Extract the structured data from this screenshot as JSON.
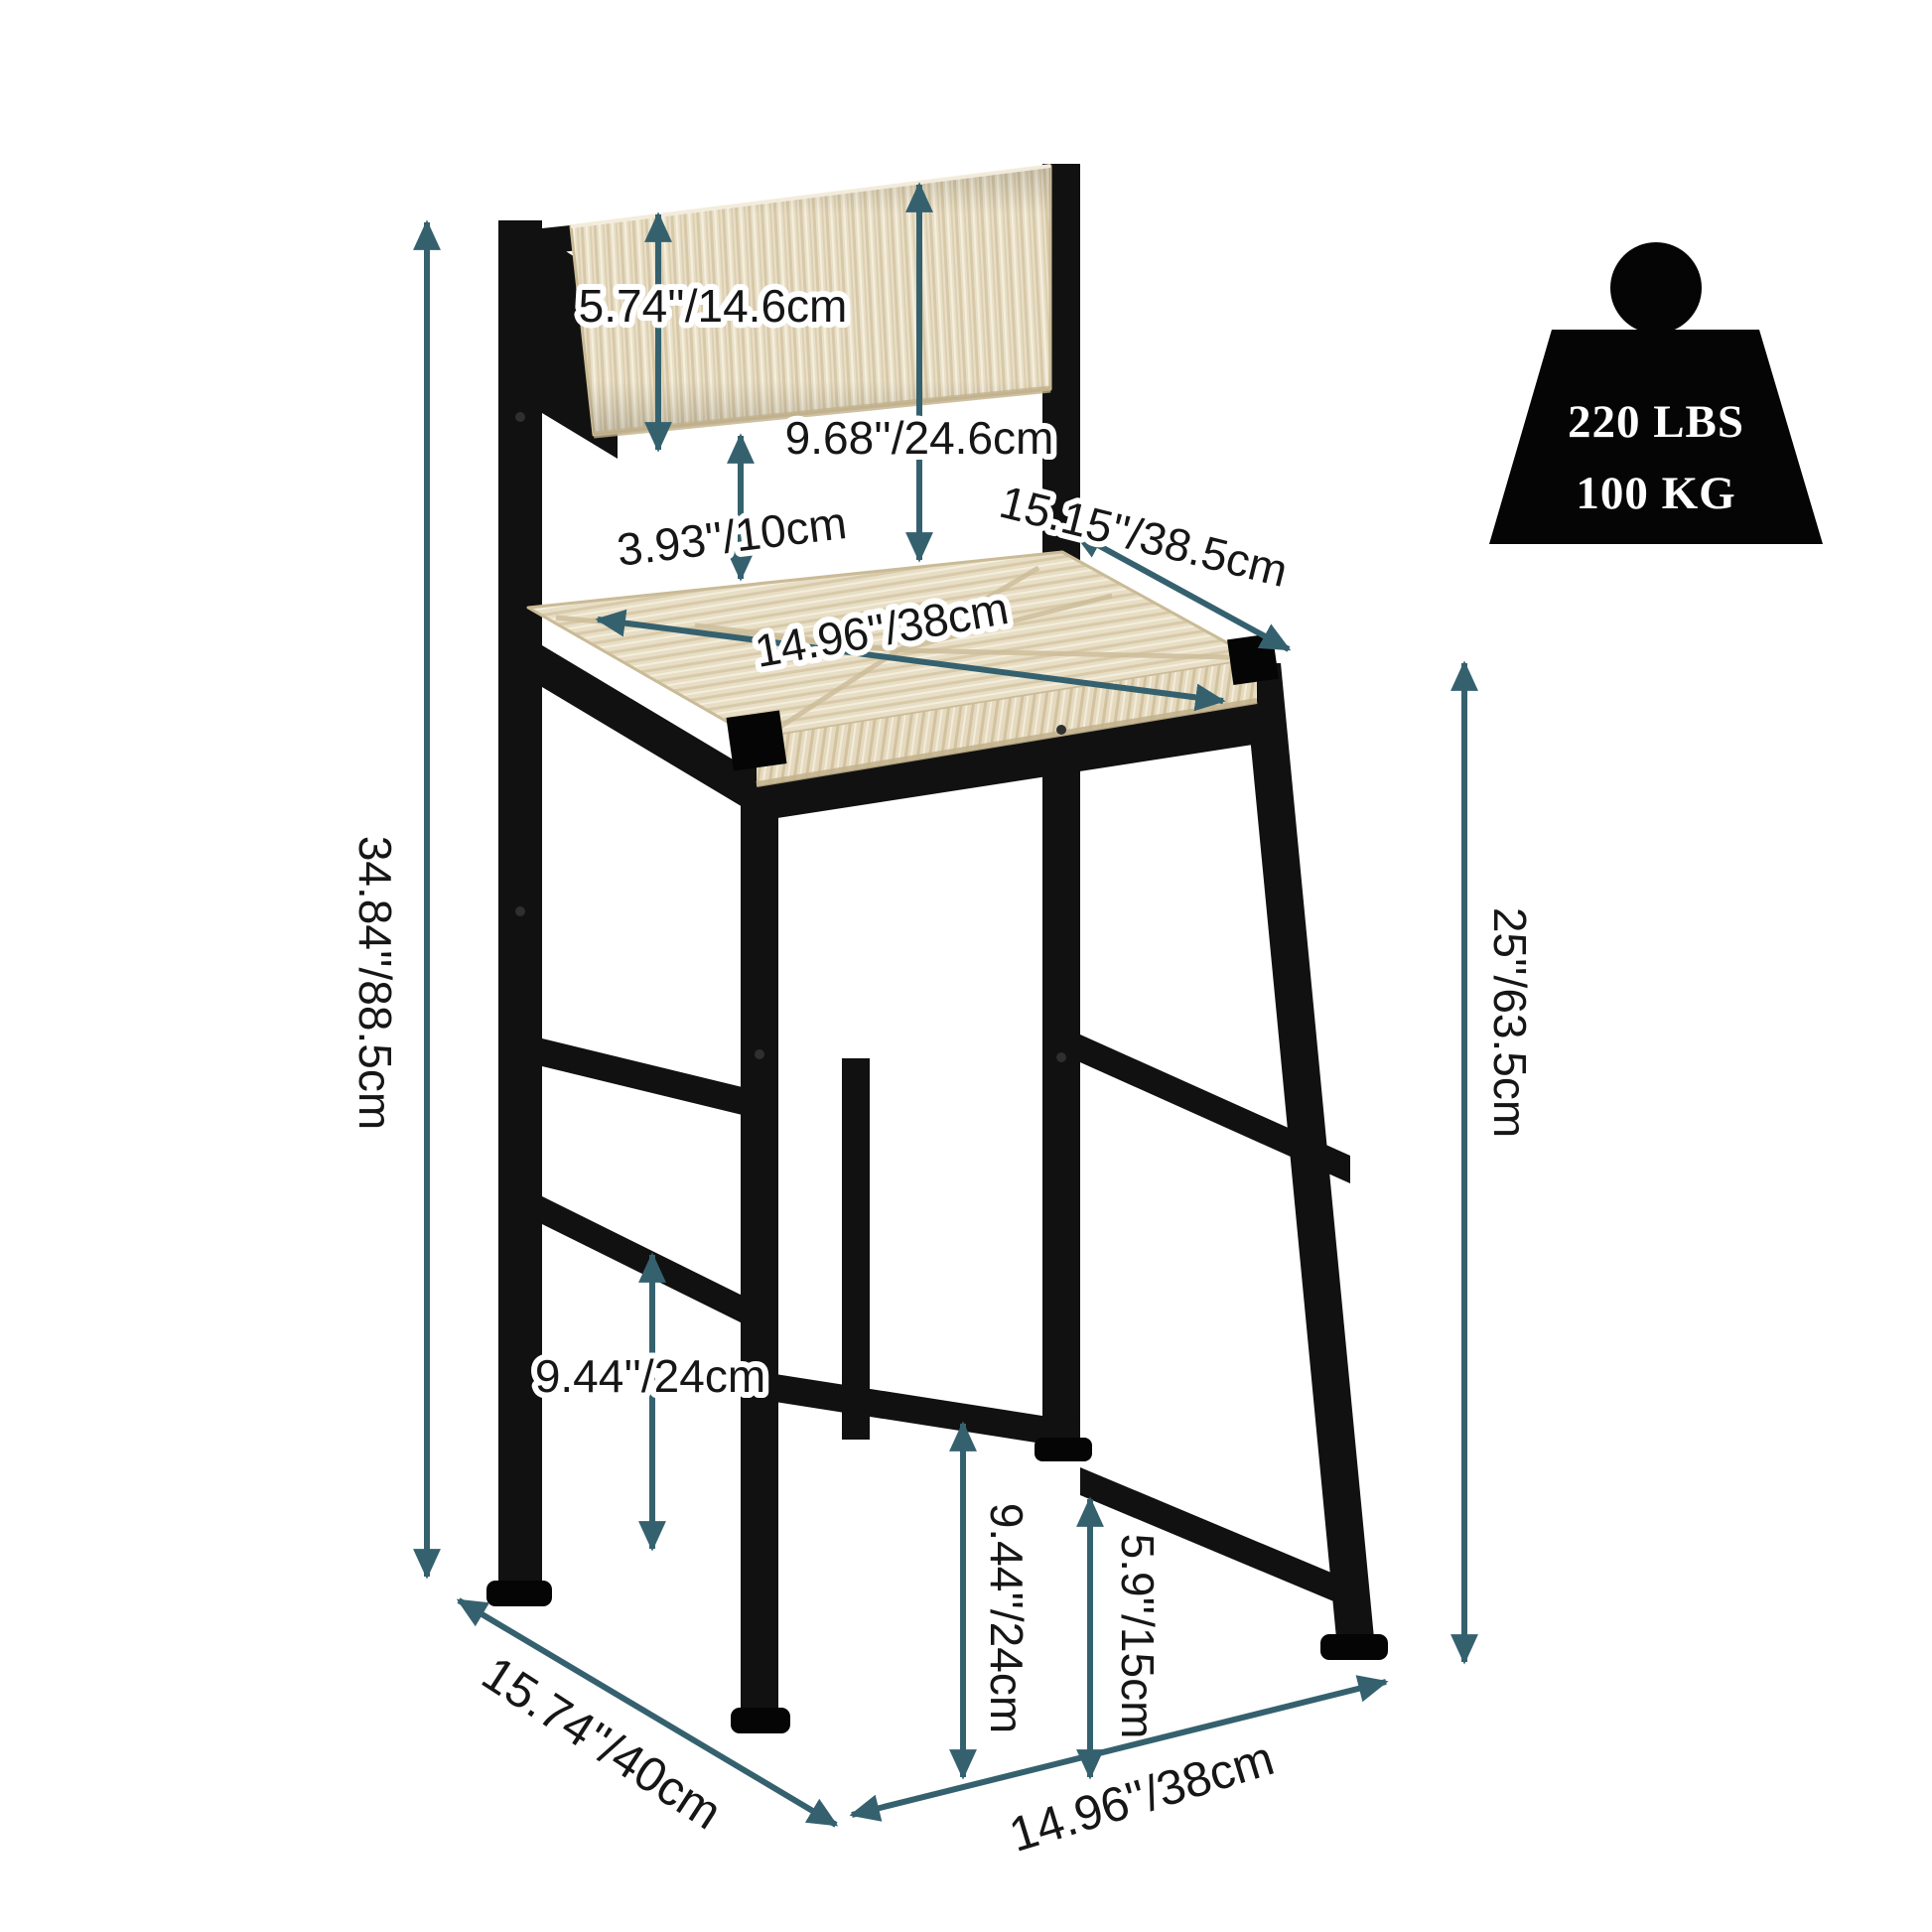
{
  "page": {
    "type": "product-dimension-diagram",
    "product": "Counter-height bar stool with black metal frame and woven paper-rush seat and backrest",
    "background": "#ffffff"
  },
  "colors": {
    "dimension_arrow": "#35616f",
    "label_text": "#161616",
    "frame_black": "#111111",
    "weave_base": "#e9dfc8",
    "weave_shadow": "#d7c9a8",
    "weave_highlight": "#f5efdd",
    "weight_icon": "#050505",
    "weight_text": "#ffffff"
  },
  "weight_capacity": {
    "pounds": "220 LBS",
    "kilograms": "100 KG"
  },
  "dimensions": {
    "total_height": {
      "label": "34.84''/88.5cm"
    },
    "backrest_height": {
      "label": "5.74''/14.6cm"
    },
    "back_top_to_seat": {
      "label": "9.68''/24.6cm"
    },
    "back_to_seat_gap": {
      "label": "3.93''/10cm"
    },
    "seat_depth": {
      "label": "15.15''/38.5cm"
    },
    "seat_width": {
      "label": "14.96''/38cm"
    },
    "seat_height": {
      "label": "25''/63.5cm"
    },
    "footrest_left": {
      "label": "9.44''/24cm"
    },
    "footrest_right": {
      "label": "9.44''/24cm"
    },
    "lower_stretcher": {
      "label": "5.9''/15cm"
    },
    "base_depth": {
      "label": "15.74''/40cm"
    },
    "base_width": {
      "label": "14.96''/38cm"
    }
  }
}
